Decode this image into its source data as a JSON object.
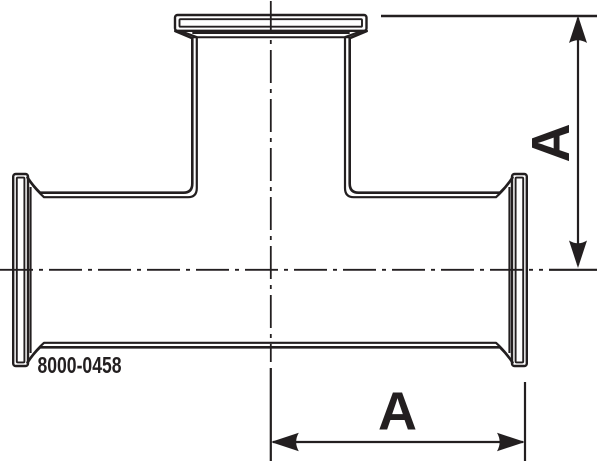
{
  "drawing": {
    "part_number": "8000-0458",
    "dimensions": {
      "vertical_label": "A",
      "horizontal_label": "A"
    },
    "colors": {
      "ink": "#231f20",
      "background": "#ffffff"
    }
  }
}
